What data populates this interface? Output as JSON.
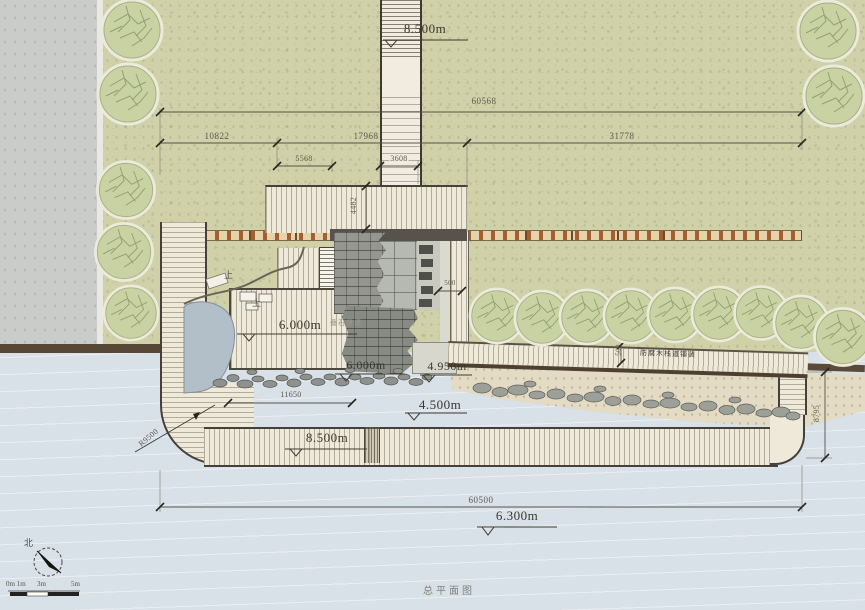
{
  "title": "总平面图",
  "compass": {
    "north_label": "北"
  },
  "scale_bar": {
    "label_0": "0m 1m",
    "label_1": "3m",
    "label_2": "5m"
  },
  "elevations": {
    "top_path": "8.500m",
    "deck": "6.000m",
    "rock_wall": "6.000m",
    "terrace": "4.950m",
    "beach": "4.500m",
    "boardwalk": "8.500m",
    "water": "6.300m"
  },
  "dimensions": {
    "top_total": "60568",
    "top_seg_left": "10822",
    "top_seg_mid": "17968",
    "top_seg_right": "31778",
    "sub_seg_left": "5568",
    "sub_seg_path": "3608",
    "deck_depth": "4482",
    "court_gap": "500",
    "walk_width": "500",
    "deck_width": "11650",
    "right_height": "8795",
    "bottom_total": "60500",
    "corner_radius": "R9500"
  },
  "annotations": {
    "boardwalk_note": "防腐木栈道铺装",
    "rock_note": "叠石景墙",
    "up_mark_1": "上",
    "up_mark_2": "上"
  },
  "colors": {
    "lawn": "#d0d1a9",
    "water": "#d9e1e8",
    "sand": "#e4dcc5",
    "deck_wood": "#efe9da",
    "tree": "#c9d2a3",
    "retaining_wall": "#594a39",
    "stone": "#90938d",
    "fence": "#e6d3ab"
  }
}
